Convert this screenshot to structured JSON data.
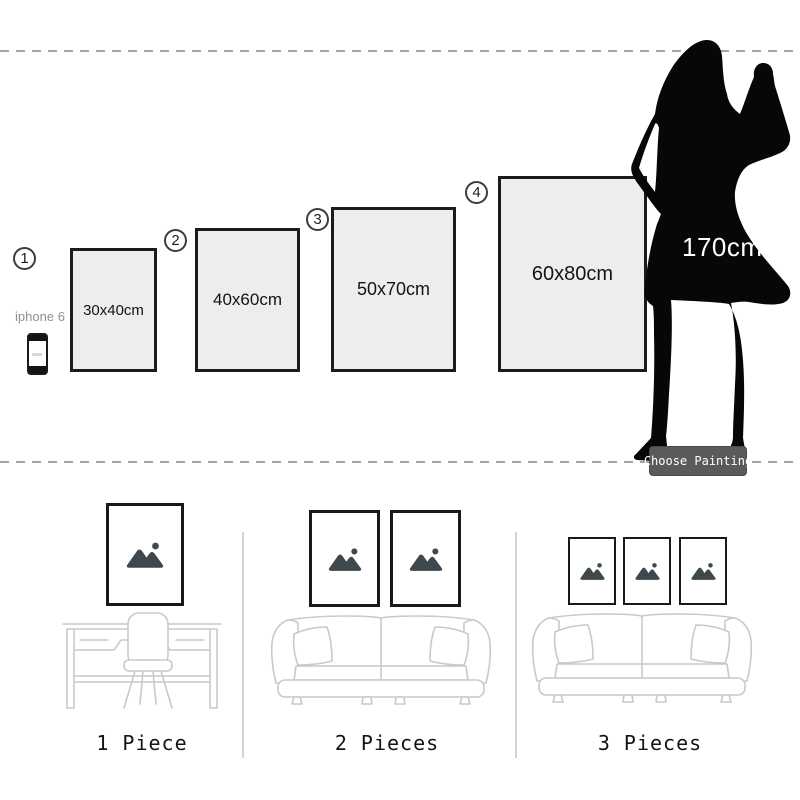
{
  "size_chart": {
    "items": [
      {
        "number": "1",
        "size": "30x40cm"
      },
      {
        "number": "2",
        "size": "40x60cm"
      },
      {
        "number": "3",
        "size": "50x70cm"
      },
      {
        "number": "4",
        "size": "60x80cm"
      }
    ],
    "phone_label": "iphone 6",
    "model_height": "170cm",
    "choose_button": "Choose Painting"
  },
  "rooms": [
    {
      "label": "1 Piece",
      "frame_count": 1
    },
    {
      "label": "2 Pieces",
      "frame_count": 2
    },
    {
      "label": "3 Pieces",
      "frame_count": 3
    }
  ],
  "icons": {
    "picture_placeholder": "mountain-sun-icon",
    "reference_person": "woman-silhouette",
    "reference_phone": "iphone-icon"
  },
  "colors": {
    "frame_fill": "#ededed",
    "frame_border": "#1b1b1b",
    "silhouette": "#070707",
    "button_bg": "#5a5a5a",
    "button_text": "#ffffff",
    "line_art": "#c9c9c9",
    "dashed_line": "#a6a6a6",
    "icon_color": "#3f484d"
  }
}
